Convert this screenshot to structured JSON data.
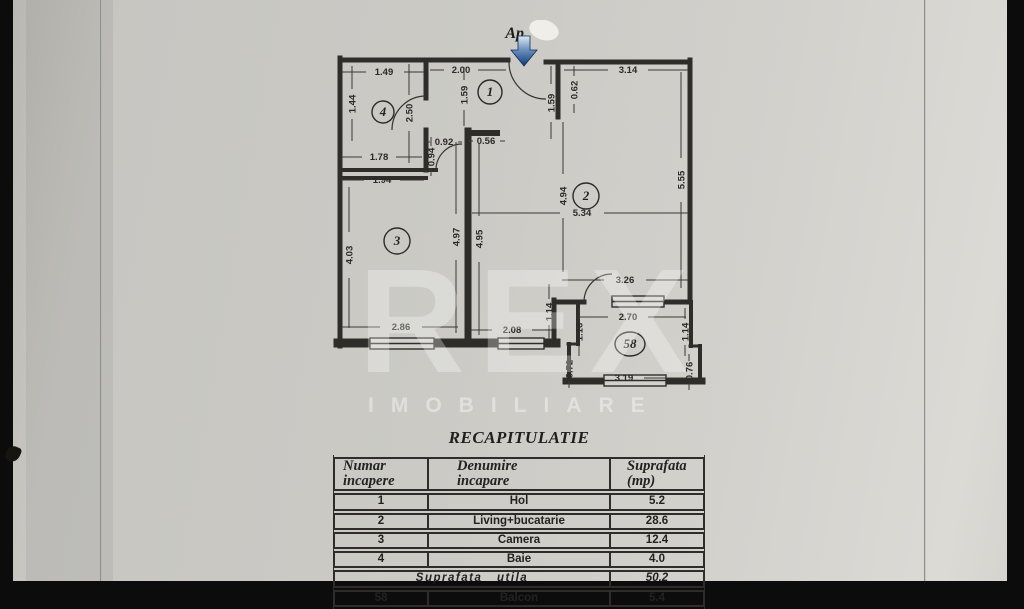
{
  "page": {
    "ap_label": "Ap."
  },
  "watermark": {
    "big": "REX",
    "sub": "IMOBILIARE"
  },
  "plan": {
    "rooms": {
      "hol": "1",
      "living": "2",
      "camera": "3",
      "baie": "4",
      "balcon": "58"
    },
    "dims": [
      "1.49",
      "1.44",
      "2.00",
      "2.50",
      "0.92",
      "0.56",
      "0.94",
      "1.78",
      "1.94",
      "1.59",
      "1.59",
      "0.62",
      "3.14",
      "5.55",
      "4.94",
      "5.34",
      "4.97",
      "4.95",
      "4.03",
      "3.26",
      "2.86",
      "2.08",
      "1.14",
      "2.70",
      "1.16",
      "1.14",
      "0.72",
      "0.76",
      "3.19"
    ]
  },
  "table": {
    "title": "RECAPITULATIE",
    "headers": [
      "Numar\nincapere",
      "Denumire\nincapare",
      "Suprafata\n(mp)"
    ],
    "rows": [
      {
        "num": "1",
        "name": "Hol",
        "area": "5.2"
      },
      {
        "num": "2",
        "name": "Living+bucatarie",
        "area": "28.6"
      },
      {
        "num": "3",
        "name": "Camera",
        "area": "12.4"
      },
      {
        "num": "4",
        "name": "Baie",
        "area": "4.0"
      }
    ],
    "summary": {
      "label": "Suprafata utila",
      "value": "50.2"
    },
    "extra_row": {
      "num": "58",
      "name": "Balcon",
      "area": "5.4"
    }
  }
}
